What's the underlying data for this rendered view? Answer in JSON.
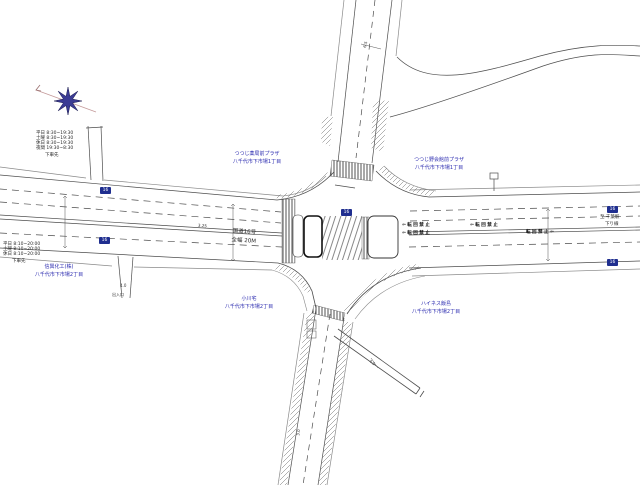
{
  "colors": {
    "background": "#ffffff",
    "road_line": "#4d4d4d",
    "sidewalk_line": "#8a8a8a",
    "label_blue": "#2b2bb0",
    "shield_navy": "#1f2e8f",
    "compass_star": "#3c3c94",
    "compass_line": "#c49a9a"
  },
  "compass": {
    "arrow": "N"
  },
  "route_shield": {
    "text": "16"
  },
  "roads": {
    "name": "国道16号",
    "width_note": "全幅 20M",
    "dest_east_line1": "至 千葉駅",
    "dest_east_line2": "下り線"
  },
  "labels": {
    "facility_nw": {
      "line1": "つつじ薬局前プラザ",
      "line2": "八千代市下市場1丁目"
    },
    "facility_ne": {
      "line1": "つつじ野会館前プラザ",
      "line2": "八千代市下市場1丁目"
    },
    "building_w": {
      "line1": "信興化工(株)",
      "line2": "八千代市下市場2丁目"
    },
    "house_s": {
      "line1": "小川宅",
      "line2": "八千代市下市場2丁目"
    },
    "building_se": {
      "line1": "ハイネス飯島",
      "line2": "八千代市下市場2丁目"
    },
    "driveway": "出入口"
  },
  "schedule_upper": {
    "rows": [
      "平日 8:30~19:30",
      "土曜 8:30~19:30",
      "休日 8:30~19:30",
      "夜間 19:30~8:30"
    ],
    "note": "下車先"
  },
  "schedule_lower": {
    "rows": [
      "平日 8:10~20:00",
      "土曜 8:10~20:00",
      "休日 8:10~20:00"
    ],
    "note": "下車先"
  },
  "road_markings": {
    "m1": "⇦転回禁止",
    "m2": "⇦転回禁止",
    "m3": "⇦転回禁止",
    "m4": "転回禁止⇦"
  },
  "dimensions": {
    "north_leg": "6.5",
    "lane": "3.25",
    "driveway": "4.0",
    "branch": "4.0",
    "south_leg": "3.0"
  }
}
